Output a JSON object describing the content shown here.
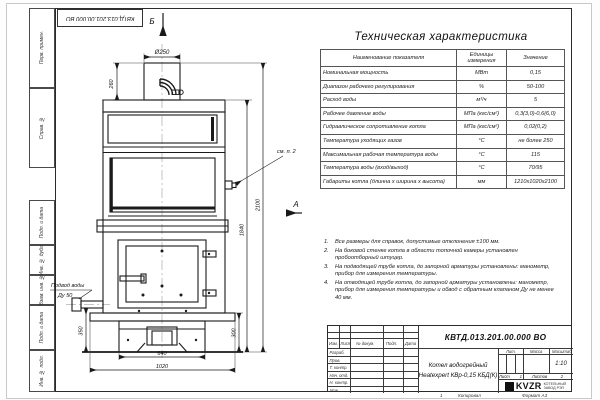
{
  "watermark": "KVZR.RU",
  "frame": {
    "top_doc_number": "КВТД.013.201.00.000 ВО",
    "left_labels": [
      "Перв. примен.",
      "Справ. №",
      "Подп. и дата",
      "Инв. № дубл.",
      "Взам. инв. №",
      "Подп. и дата",
      "Инв. № подл."
    ],
    "bottom": {
      "marker": "1",
      "copied": "Копировал",
      "format": "Формат А3"
    }
  },
  "drawing": {
    "view_top": "Б",
    "view_side": "А",
    "see_note": "см. п. 2",
    "inlet_line1": "Подвод воды",
    "inlet_line2": "Ду 50",
    "dim_flue_dia": "Ø250",
    "dim_flue_h": "260",
    "dim_total_h": "2100",
    "dim_body_h": "1840",
    "dim_inlet_h": "350",
    "dim_base_h": "300",
    "dim_base_w": "640",
    "dim_body_w": "1020"
  },
  "spec": {
    "title": "Техническая характеристика",
    "col_name": "Наименование показателя",
    "col_units": "Единицы измерения",
    "col_value": "Значение",
    "rows": [
      {
        "name": "Номинальная мощность",
        "units": "МВт",
        "value": "0,15"
      },
      {
        "name": "Диапазон рабочего регулирования",
        "units": "%",
        "value": "50-100"
      },
      {
        "name": "Расход воды",
        "units": "м³/ч",
        "value": "5"
      },
      {
        "name": "Рабочее давление воды",
        "units": "МПа (кгс/см²)",
        "value": "0,3(3,0)-0,6(6,0)"
      },
      {
        "name": "Гидравлическое сопротивление котла",
        "units": "МПа (кгс/см²)",
        "value": "0,02(0,2)"
      },
      {
        "name": "Температура уходящих газов",
        "units": "°С",
        "value": "не более 250"
      },
      {
        "name": "Максимальная рабочая температура воды",
        "units": "°С",
        "value": "115"
      },
      {
        "name": "Температура воды (вход/выход)",
        "units": "°С",
        "value": "70/95"
      },
      {
        "name": "Габариты котла (длинна х ширина х высота)",
        "units": "мм",
        "value": "1210х1020х2100"
      }
    ]
  },
  "notes": {
    "items": [
      {
        "num": "1.",
        "text": "Все размеры для справок, допустимые отклонения ±100 мм."
      },
      {
        "num": "2.",
        "text": "На боковой стенке котла в области топочной камеры установлен пробоотборный штуцер."
      },
      {
        "num": "3.",
        "text": "На подводящей трубе котла, до запорной арматуры установлены: манометр, прибор для измерения температуры."
      },
      {
        "num": "4.",
        "text": "На отводящей трубе котла, до запорной арматуры установлены: манометр, прибор для измерения температуры и обвод с обратным клапаном Ду не менее 40 мм."
      }
    ]
  },
  "title_block": {
    "doc_number": "КВТД.013.201.00.000 ВО",
    "name_line1": "Котел водогрейный",
    "name_line2": "Heatexpert КВр-0,15 КБД(К)",
    "cols": [
      "Изм.",
      "Лист",
      "№ докум.",
      "Подп.",
      "Дата"
    ],
    "rows": [
      "Разраб.",
      "Пров.",
      "Т. контр.",
      "Нач. отд.",
      "Н. контр.",
      "Утв."
    ],
    "lit": "Лит.",
    "mass": "Масса",
    "scale": "Масштаб",
    "scale_value": "1:10",
    "sheet": "Лист",
    "sheet_value": "1",
    "sheets": "Листов",
    "sheets_value": "2",
    "logo": "KVZR",
    "company_line1": "КОТЕЛЬНЫЙ",
    "company_line2": "ЗАВОД РЭП"
  }
}
